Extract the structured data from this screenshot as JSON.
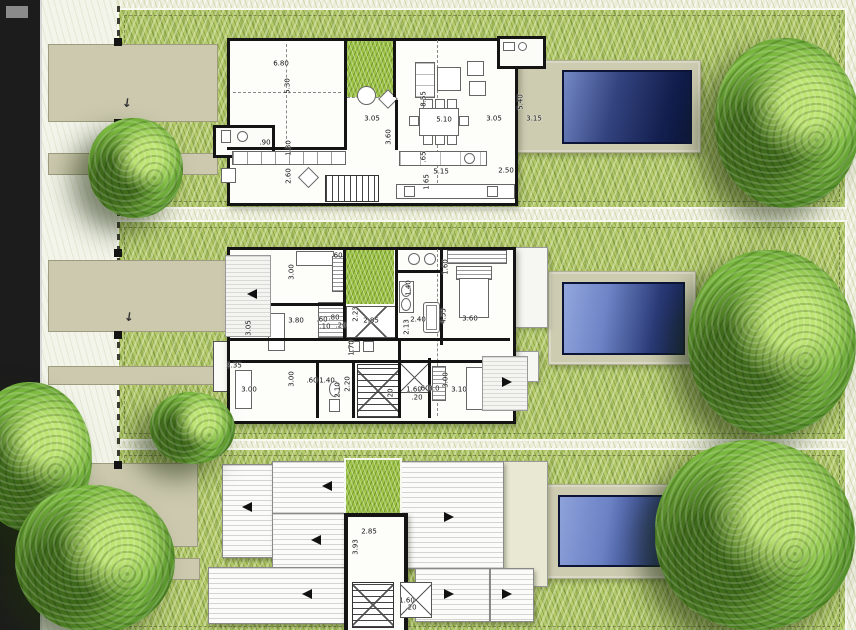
{
  "colors": {
    "street": "#1c1c1c",
    "sidewalk": "#f3f4ea",
    "grass": "#b3c96b",
    "grass_bright": "#9cc248",
    "pale_strip": "#ecedda",
    "path": "#ccc9ae",
    "deck": "#cdcbb0",
    "wall": "#141414",
    "pool_deep": "#0d1840",
    "pool_light": "#8fa3da"
  },
  "plans": {
    "ground_floor": {
      "dims": [
        {
          "t": "6.80",
          "x": 281,
          "y": 64
        },
        {
          "t": "5.30",
          "x": 288,
          "y": 86,
          "v": true
        },
        {
          "t": ".90",
          "x": 265,
          "y": 143
        },
        {
          "t": "1.30",
          "x": 289,
          "y": 148,
          "v": true
        },
        {
          "t": "2.60",
          "x": 289,
          "y": 176,
          "v": true
        },
        {
          "t": "3.05",
          "x": 372,
          "y": 119
        },
        {
          "t": "3.60",
          "x": 389,
          "y": 137,
          "v": true
        },
        {
          "t": "8.55",
          "x": 424,
          "y": 99,
          "v": true
        },
        {
          "t": "5.10",
          "x": 444,
          "y": 120
        },
        {
          "t": ".65",
          "x": 424,
          "y": 157,
          "v": true
        },
        {
          "t": "5.15",
          "x": 441,
          "y": 172
        },
        {
          "t": "2.50",
          "x": 506,
          "y": 171
        },
        {
          "t": "1.65",
          "x": 427,
          "y": 182,
          "v": true
        },
        {
          "t": "5.40",
          "x": 521,
          "y": 102,
          "v": true
        },
        {
          "t": "3.15",
          "x": 534,
          "y": 119
        },
        {
          "t": "3.05",
          "x": 494,
          "y": 119
        }
      ]
    },
    "upper_floor": {
      "dims": [
        {
          "t": "3.00",
          "x": 292,
          "y": 272,
          "v": true
        },
        {
          "t": ".60",
          "x": 337,
          "y": 256
        },
        {
          "t": "1.60",
          "x": 446,
          "y": 267,
          "v": true
        },
        {
          "t": "3.80",
          "x": 296,
          "y": 321
        },
        {
          "t": "3.05",
          "x": 249,
          "y": 328,
          "v": true
        },
        {
          "t": ".60",
          "x": 322,
          "y": 320
        },
        {
          "t": ".80",
          "x": 334,
          "y": 318
        },
        {
          "t": ".10",
          "x": 325,
          "y": 327
        },
        {
          "t": ".20",
          "x": 341,
          "y": 326
        },
        {
          "t": "2.85",
          "x": 371,
          "y": 321
        },
        {
          "t": "2.23",
          "x": 356,
          "y": 314,
          "v": true
        },
        {
          "t": "1.40",
          "x": 409,
          "y": 288,
          "v": true
        },
        {
          "t": "2.40",
          "x": 418,
          "y": 320
        },
        {
          "t": "2.13",
          "x": 407,
          "y": 327,
          "v": true
        },
        {
          "t": "4.55",
          "x": 444,
          "y": 316,
          "v": true
        },
        {
          "t": "3.60",
          "x": 470,
          "y": 319
        },
        {
          "t": "2.35",
          "x": 234,
          "y": 366
        },
        {
          "t": "1.70",
          "x": 352,
          "y": 348,
          "v": true
        },
        {
          "t": "3.00",
          "x": 292,
          "y": 379,
          "v": true
        },
        {
          "t": "3.00",
          "x": 249,
          "y": 390
        },
        {
          "t": ".60",
          "x": 312,
          "y": 381
        },
        {
          "t": "1.40",
          "x": 327,
          "y": 381
        },
        {
          "t": "2.10",
          "x": 338,
          "y": 390,
          "v": true
        },
        {
          "t": "2.20",
          "x": 348,
          "y": 384,
          "v": true
        },
        {
          "t": ".20",
          "x": 391,
          "y": 394,
          "v": true
        },
        {
          "t": "1.60",
          "x": 414,
          "y": 390
        },
        {
          "t": ".20",
          "x": 417,
          "y": 398
        },
        {
          "t": ".60",
          "x": 424,
          "y": 389
        },
        {
          "t": "3.0",
          "x": 434,
          "y": 389
        },
        {
          "t": "3.10",
          "x": 459,
          "y": 390
        },
        {
          "t": "3.00",
          "x": 446,
          "y": 380,
          "v": true
        }
      ]
    },
    "roof": {
      "dims": [
        {
          "t": "2.85",
          "x": 369,
          "y": 532
        },
        {
          "t": "3.93",
          "x": 356,
          "y": 547,
          "v": true
        },
        {
          "t": "1.60",
          "x": 407,
          "y": 601
        },
        {
          "t": ".20",
          "x": 411,
          "y": 608
        }
      ]
    }
  },
  "site": {
    "slope_arrows": [
      {
        "dir": "left",
        "x": 252,
        "y": 294
      },
      {
        "dir": "right",
        "x": 507,
        "y": 382
      },
      {
        "dir": "left",
        "x": 327,
        "y": 486
      },
      {
        "dir": "left",
        "x": 247,
        "y": 507
      },
      {
        "dir": "left",
        "x": 316,
        "y": 540
      },
      {
        "dir": "left",
        "x": 307,
        "y": 594
      },
      {
        "dir": "right",
        "x": 449,
        "y": 517
      },
      {
        "dir": "right",
        "x": 449,
        "y": 594
      },
      {
        "dir": "right",
        "x": 507,
        "y": 594
      }
    ],
    "entry_arrows": [
      {
        "x": 127,
        "y": 103
      },
      {
        "x": 129,
        "y": 317
      },
      {
        "x": 130,
        "y": 529
      }
    ],
    "fence_posts": [
      {
        "x": 114,
        "y": 38
      },
      {
        "x": 114,
        "y": 119
      },
      {
        "x": 114,
        "y": 249
      },
      {
        "x": 114,
        "y": 331
      },
      {
        "x": 114,
        "y": 461
      },
      {
        "x": 114,
        "y": 543
      }
    ],
    "entry_arrow_glyph": "↓"
  }
}
